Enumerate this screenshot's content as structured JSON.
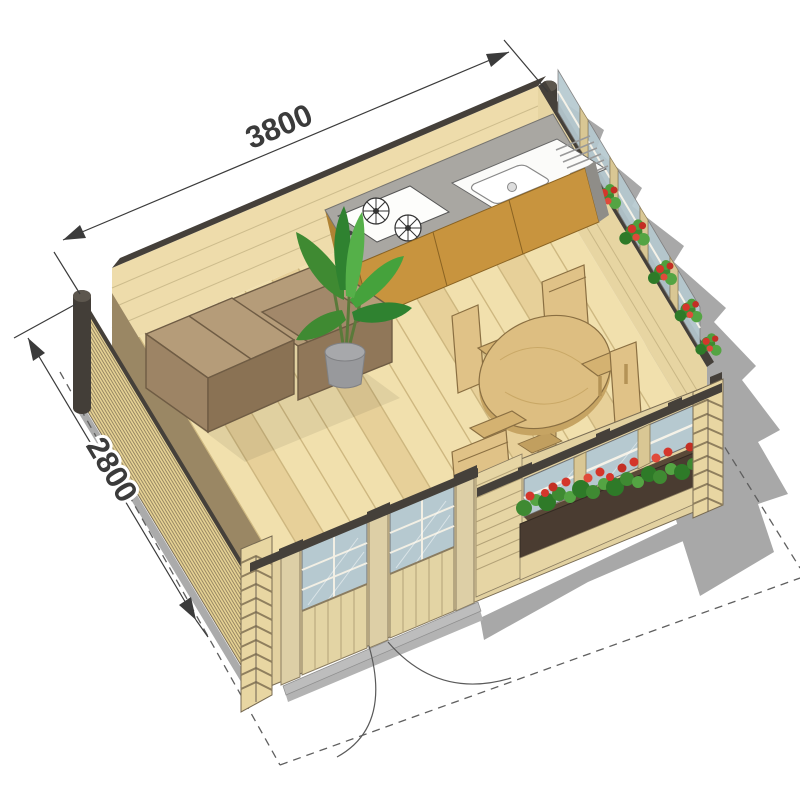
{
  "drawing": {
    "type": "isometric-cutaway-floor-plan",
    "subject": "garden log cabin interior plan"
  },
  "dimensions": {
    "width_label": "3800",
    "depth_label": "2800"
  },
  "scene": {
    "objects": [
      "log-cabin-walls",
      "wood-plank-floor",
      "kitchen-counter",
      "gas-cooktop",
      "sink-with-drainer",
      "kitchen-cabinets",
      "corner-sofa",
      "potted-plant",
      "round-dining-table",
      "dining-chair-north",
      "dining-chair-west",
      "dining-chair-south",
      "dining-chair-east",
      "window-flower-boxes",
      "red-flowers",
      "glazed-double-doors",
      "door-swing-arcs",
      "roof-overhang-dashed-outline",
      "cast-shadow",
      "corner-log-joints"
    ]
  },
  "colors": {
    "wall_exterior": "#e5d193",
    "wall_interior": "#eedcab",
    "wall_cap": "#45403a",
    "floor": "#f1e0ad",
    "floor_line": "#c8b179",
    "counter_top": "#a9a7a2",
    "cabinet": "#c8943e",
    "sofa": "#b59c79",
    "table_wood": "#ddbe81",
    "chair_wood": "#e0c287",
    "glass": "#b6c9d0",
    "flower_red": "#d4362b",
    "leaf_green": "#3f8a32",
    "planter_box": "#4a3c31",
    "shadow": "#a8a8a8",
    "post_dark": "#433e38",
    "dimension": "#3b3b3b"
  }
}
